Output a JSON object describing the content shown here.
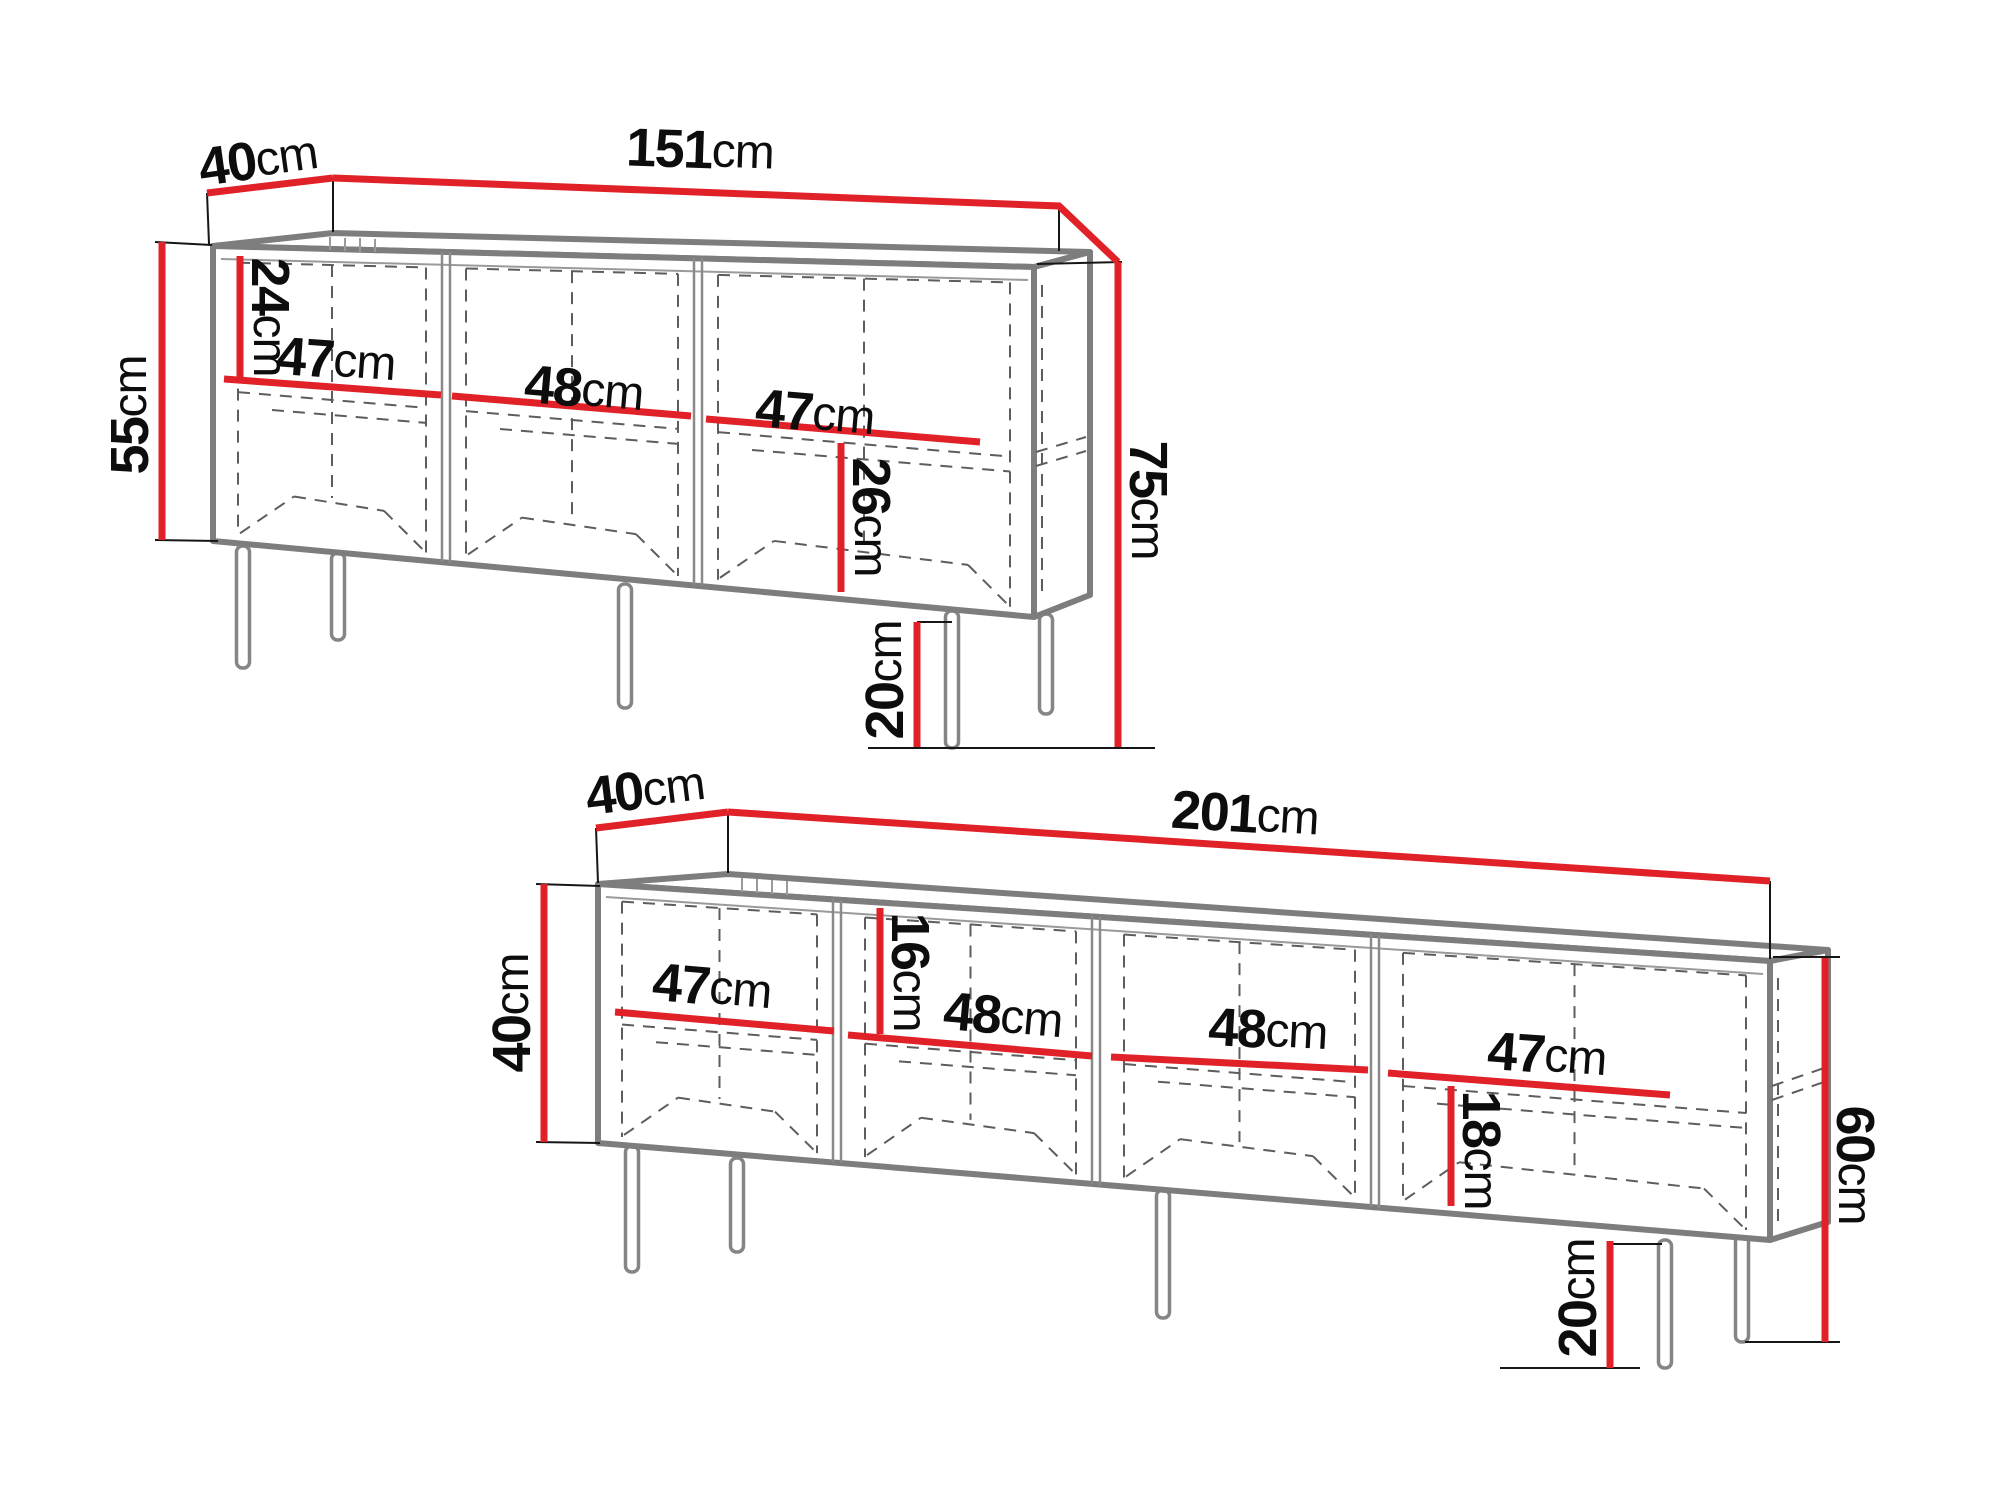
{
  "diagram": {
    "type": "furniture-dimension-diagram",
    "views": 2
  },
  "colors": {
    "dimension_red": "#e02127",
    "outline_gray": "#7d7d7d",
    "dashed_gray": "#5d5d5d",
    "extension_black": "#161616",
    "background": "#ffffff"
  },
  "sideboard": {
    "depth": {
      "value": "40",
      "unit": "cm"
    },
    "width": {
      "value": "151",
      "unit": "cm"
    },
    "body_height": {
      "value": "55",
      "unit": "cm"
    },
    "total_height": {
      "value": "75",
      "unit": "cm"
    },
    "upper_section_height": {
      "value": "24",
      "unit": "cm"
    },
    "lower_section_height": {
      "value": "26",
      "unit": "cm"
    },
    "leg_height": {
      "value": "20",
      "unit": "cm"
    },
    "shelf_widths": [
      {
        "value": "47",
        "unit": "cm"
      },
      {
        "value": "48",
        "unit": "cm"
      },
      {
        "value": "47",
        "unit": "cm"
      }
    ]
  },
  "tv_stand": {
    "depth": {
      "value": "40",
      "unit": "cm"
    },
    "width": {
      "value": "201",
      "unit": "cm"
    },
    "body_height": {
      "value": "40",
      "unit": "cm"
    },
    "total_height": {
      "value": "60",
      "unit": "cm"
    },
    "upper_section_height": {
      "value": "16",
      "unit": "cm"
    },
    "lower_section_height": {
      "value": "18",
      "unit": "cm"
    },
    "leg_height": {
      "value": "20",
      "unit": "cm"
    },
    "shelf_widths": [
      {
        "value": "47",
        "unit": "cm"
      },
      {
        "value": "48",
        "unit": "cm"
      },
      {
        "value": "48",
        "unit": "cm"
      },
      {
        "value": "47",
        "unit": "cm"
      }
    ]
  }
}
